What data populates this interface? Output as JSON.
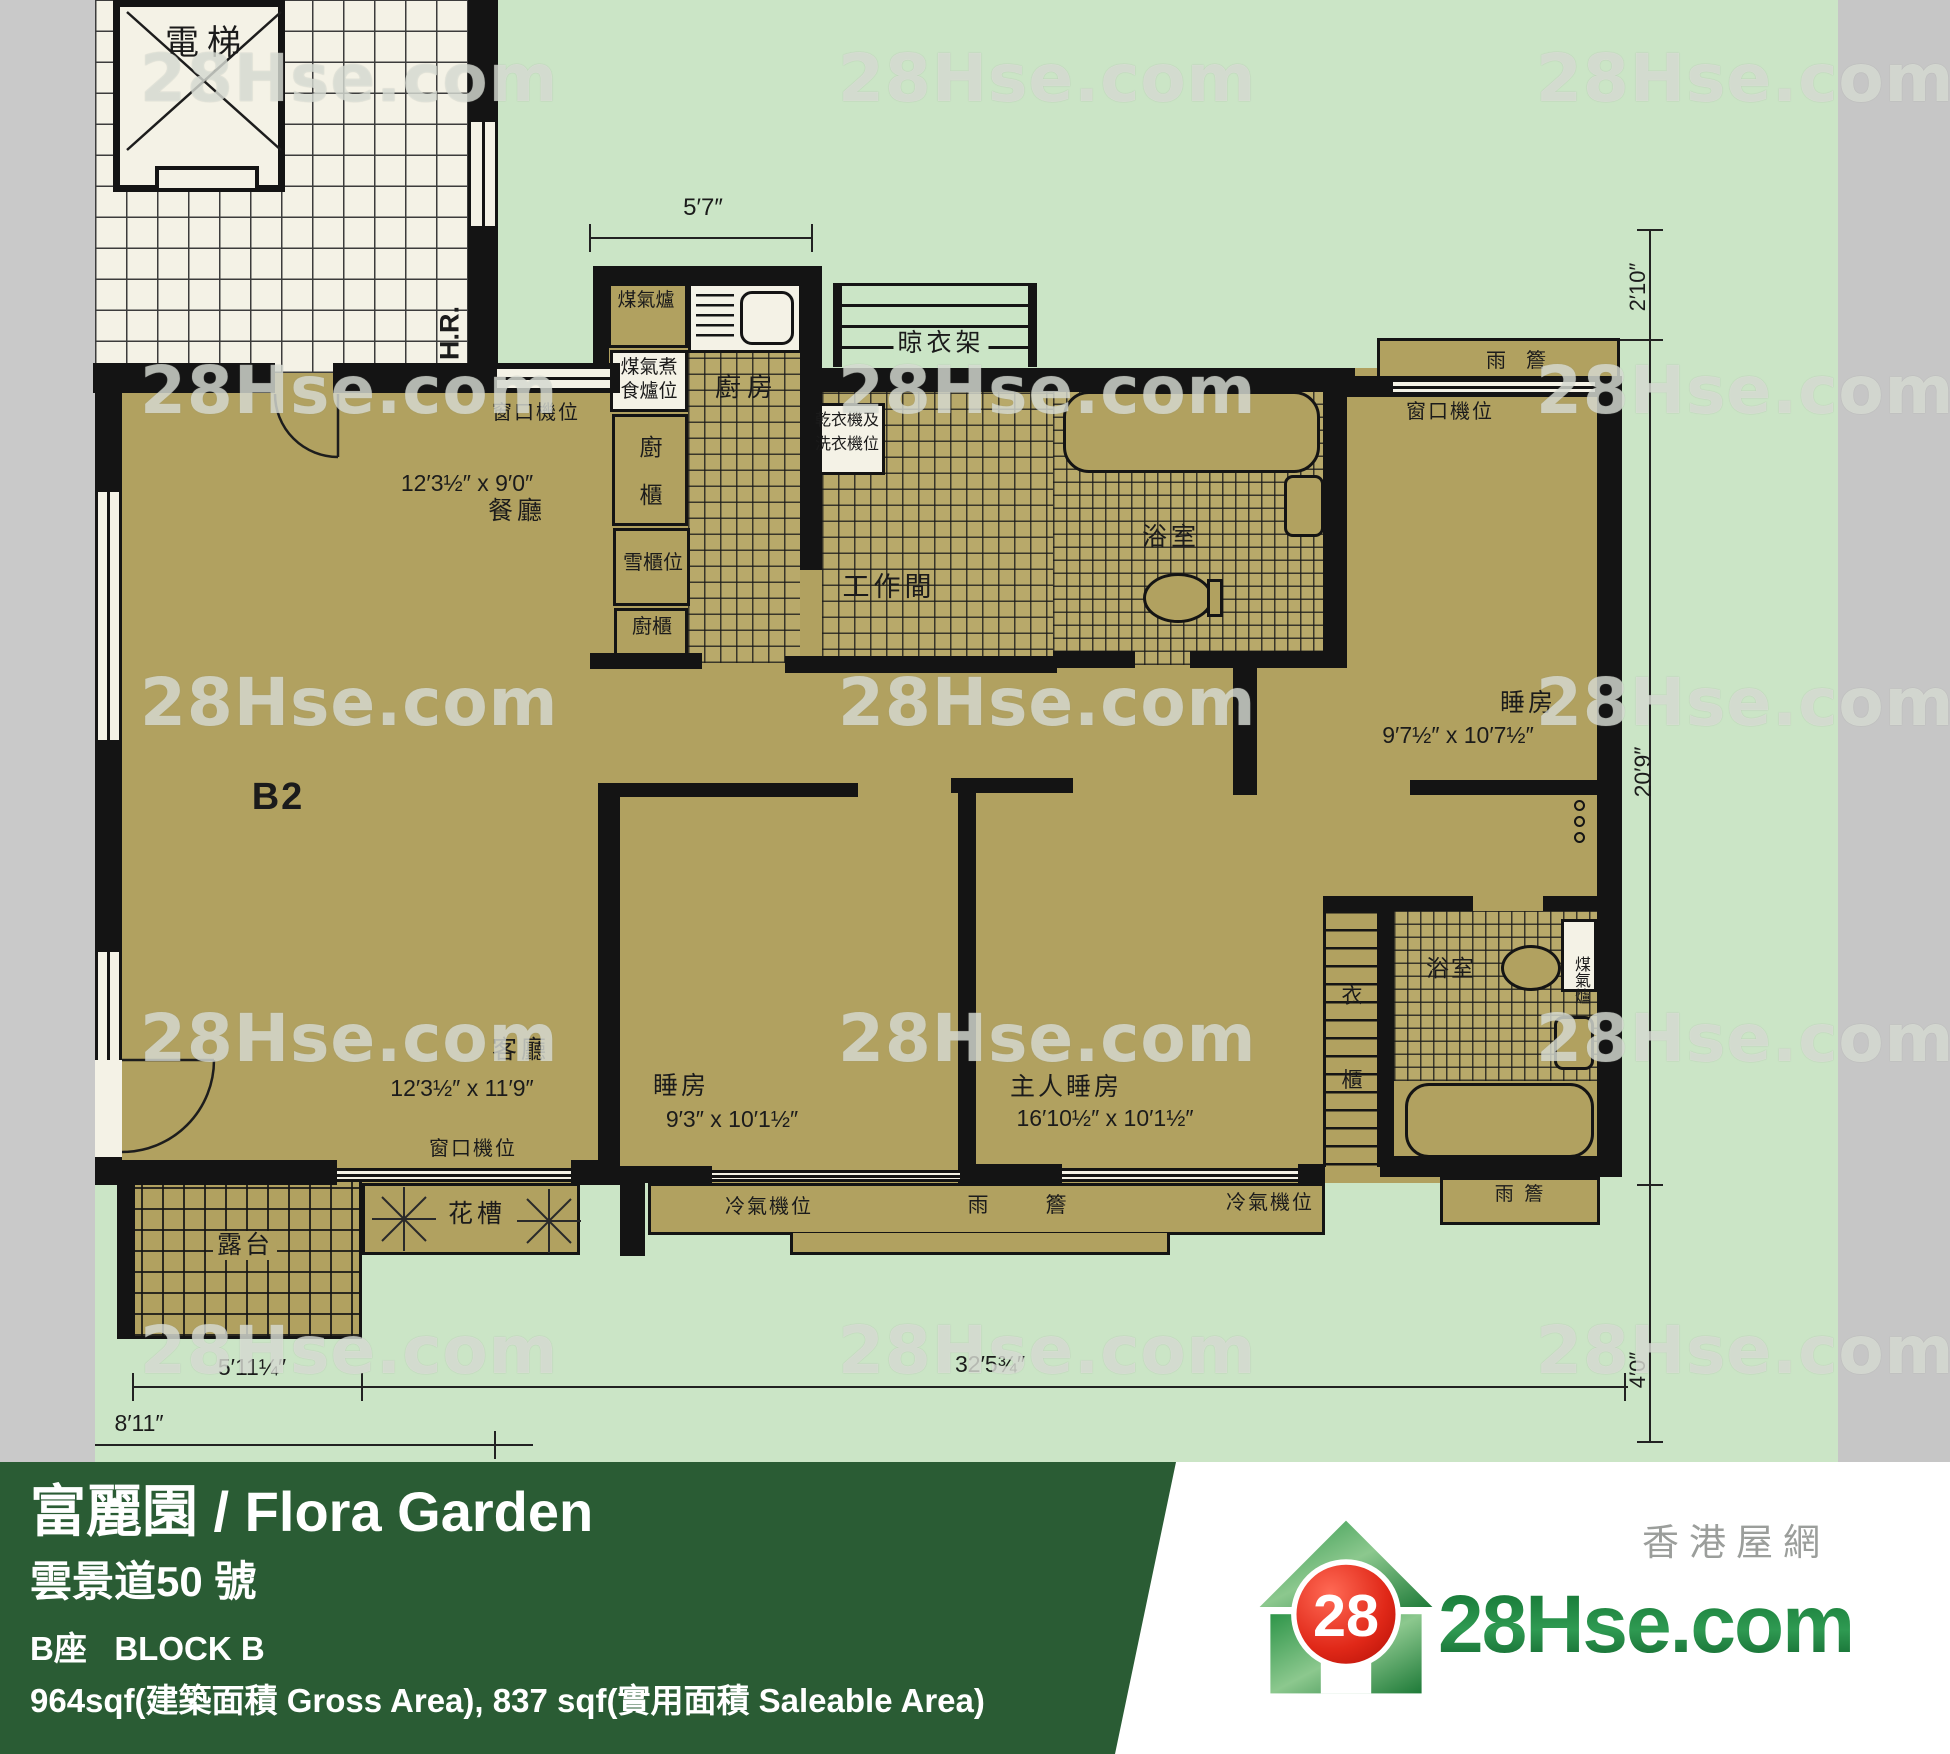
{
  "colors": {
    "plan_bg": "#cbe5c6",
    "floor_tan": "#b1a160",
    "wall": "#141414",
    "lobby_white": "#f4f2e6",
    "gray_strip": "#c9c9c9",
    "footer_green": "#2a5c34",
    "logo_green": "#1e8540",
    "logo_red": "#d81e12",
    "wm_color": "rgba(238,241,233,0.62)"
  },
  "plan": {
    "watermark": {
      "text": "28Hse.com",
      "rows": [
        40,
        352,
        664,
        1000,
        1312
      ],
      "cols": [
        140,
        838,
        1536
      ]
    },
    "labels": [
      {
        "n": "elevator-label",
        "t": "電梯",
        "x": 207,
        "y": 26,
        "fs": 34,
        "ls": 8
      },
      {
        "n": "hose-reel-label",
        "t": "H.R.",
        "x": 450,
        "y": 333,
        "fs": 27,
        "rot": -90,
        "bold": true
      },
      {
        "n": "gas-stove-label",
        "t": "煤氣爐",
        "x": 646,
        "y": 291,
        "fs": 19
      },
      {
        "n": "gas-cooker-pos-label-line1",
        "t": "煤氣煮",
        "x": 649,
        "y": 358,
        "fs": 19
      },
      {
        "n": "gas-cooker-pos-label-line2",
        "t": "食爐位",
        "x": 649,
        "y": 382,
        "fs": 19
      },
      {
        "n": "kitchen-label",
        "t": "廚房",
        "x": 747,
        "y": 374,
        "fs": 26,
        "ls": 6
      },
      {
        "n": "kitchen-cabinet-label-char1",
        "t": "廚",
        "x": 651,
        "y": 436,
        "fs": 23
      },
      {
        "n": "kitchen-cabinet-label-char2",
        "t": "櫃",
        "x": 651,
        "y": 484,
        "fs": 23
      },
      {
        "n": "fridge-pos-label",
        "t": "雪櫃位",
        "x": 653,
        "y": 553,
        "fs": 20
      },
      {
        "n": "kitchen-cabinet2-label",
        "t": "廚櫃",
        "x": 652,
        "y": 617,
        "fs": 20
      },
      {
        "n": "drying-rack-label",
        "t": "晾衣架",
        "x": 941,
        "y": 329,
        "fs": 25,
        "ls": 4,
        "bg": "green"
      },
      {
        "n": "dryer-washer-pos-label-line1",
        "t": "乾衣機及",
        "x": 847,
        "y": 413,
        "fs": 16
      },
      {
        "n": "dryer-washer-pos-label-line2",
        "t": "洗衣機位",
        "x": 847,
        "y": 437,
        "fs": 16
      },
      {
        "n": "workroom-label",
        "t": "工作間",
        "x": 889,
        "y": 574,
        "fs": 27,
        "ls": 4
      },
      {
        "n": "bathroom1-label",
        "t": "浴室",
        "x": 1171,
        "y": 525,
        "fs": 25,
        "ls": 4
      },
      {
        "n": "window-ac-label-dining",
        "t": "窗口機位",
        "x": 536,
        "y": 403,
        "fs": 20,
        "ls": 2
      },
      {
        "n": "dining-dims-label",
        "t": "12′3½″ x 9′0″",
        "x": 467,
        "y": 472,
        "fs": 23
      },
      {
        "n": "dining-label",
        "t": "餐廳",
        "x": 517,
        "y": 499,
        "fs": 25,
        "ls": 4
      },
      {
        "n": "unit-label",
        "t": "B2",
        "x": 278,
        "y": 778,
        "fs": 38,
        "bold": true,
        "ls": 2
      },
      {
        "n": "canopy-label-top",
        "t": "雨　簷",
        "x": 1516,
        "y": 351,
        "fs": 20
      },
      {
        "n": "window-ac-label-bedroom1",
        "t": "窗口機位",
        "x": 1450,
        "y": 402,
        "fs": 20,
        "ls": 2
      },
      {
        "n": "bedroom1-label",
        "t": "睡房",
        "x": 1528,
        "y": 691,
        "fs": 25,
        "ls": 3
      },
      {
        "n": "bedroom1-dims-label",
        "t": "9′7½″ x 10′7½″",
        "x": 1458,
        "y": 724,
        "fs": 23
      },
      {
        "n": "dim-right-upper",
        "t": "2′10″",
        "x": 1638,
        "y": 287,
        "fs": 22,
        "rot": -90
      },
      {
        "n": "dim-right-middle",
        "t": "20′9″",
        "x": 1643,
        "y": 772,
        "fs": 23,
        "rot": -90
      },
      {
        "n": "dim-right-lower",
        "t": "4′0″",
        "x": 1638,
        "y": 1370,
        "fs": 22,
        "rot": -90
      },
      {
        "n": "living-label",
        "t": "客廳",
        "x": 521,
        "y": 1038,
        "fs": 25,
        "ls": 4
      },
      {
        "n": "living-dims-label",
        "t": "12′3½″ x 11′9″",
        "x": 462,
        "y": 1077,
        "fs": 23
      },
      {
        "n": "window-ac-label-living",
        "t": "窗口機位",
        "x": 473,
        "y": 1139,
        "fs": 20,
        "ls": 2
      },
      {
        "n": "bedroom2-label",
        "t": "睡房",
        "x": 681,
        "y": 1074,
        "fs": 25,
        "ls": 3
      },
      {
        "n": "bedroom2-dims-label",
        "t": "9′3″ x 10′1½″",
        "x": 732,
        "y": 1108,
        "fs": 23
      },
      {
        "n": "master-bedroom-label",
        "t": "主人睡房",
        "x": 1066,
        "y": 1075,
        "fs": 25,
        "ls": 3
      },
      {
        "n": "master-bedroom-dims-label",
        "t": "16′10½″ x 10′1½″",
        "x": 1105,
        "y": 1107,
        "fs": 23
      },
      {
        "n": "wardrobe-label-char1",
        "t": "衣",
        "x": 1352,
        "y": 986,
        "fs": 21
      },
      {
        "n": "wardrobe-label-char2",
        "t": "櫃",
        "x": 1352,
        "y": 1070,
        "fs": 21
      },
      {
        "n": "bathroom2-label",
        "t": "浴室",
        "x": 1451,
        "y": 957,
        "fs": 23,
        "ls": 2
      },
      {
        "n": "gas-heater-label",
        "t": "煤氣爐",
        "x": 1580,
        "y": 956,
        "fs": 16,
        "vert": true
      },
      {
        "n": "canopy-label-ensuite",
        "t": "雨  簷",
        "x": 1519,
        "y": 1185,
        "fs": 19
      },
      {
        "n": "ac-pos-label-left",
        "t": "冷氣機位",
        "x": 769,
        "y": 1197,
        "fs": 20,
        "ls": 2
      },
      {
        "n": "canopy-label-main-char1",
        "t": "雨",
        "x": 978,
        "y": 1195,
        "fs": 21
      },
      {
        "n": "canopy-label-main-char2",
        "t": "簷",
        "x": 1056,
        "y": 1195,
        "fs": 21
      },
      {
        "n": "ac-pos-label-right",
        "t": "冷氣機位",
        "x": 1270,
        "y": 1193,
        "fs": 20,
        "ls": 2
      },
      {
        "n": "balcony-label",
        "t": "露台",
        "x": 245,
        "y": 1231,
        "fs": 25,
        "ls": 3,
        "bg": "tan"
      },
      {
        "n": "flower-bed-label",
        "t": "花槽",
        "x": 477,
        "y": 1202,
        "fs": 25,
        "ls": 4
      },
      {
        "n": "dim-kitchen-width",
        "t": "5′7″",
        "x": 703,
        "y": 196,
        "fs": 24
      },
      {
        "n": "dim-balcony-width",
        "t": "5′11¼″",
        "x": 252,
        "y": 1356,
        "fs": 23
      },
      {
        "n": "dim-bottom-width",
        "t": "32′5¾″",
        "x": 990,
        "y": 1353,
        "fs": 23
      },
      {
        "n": "dim-left-offset",
        "t": "8′11″",
        "x": 139,
        "y": 1412,
        "fs": 23
      }
    ]
  },
  "footer": {
    "title": "富麗園 / Flora Garden",
    "address": "雲景道50 號",
    "block": "B座   BLOCK B",
    "area": "964sqf(建築面積 Gross Area), 837 sqf(實用面積 Saleable Area)"
  },
  "logo": {
    "brand": "28Hse.com",
    "badge": "28",
    "tagline": "香港屋網"
  }
}
